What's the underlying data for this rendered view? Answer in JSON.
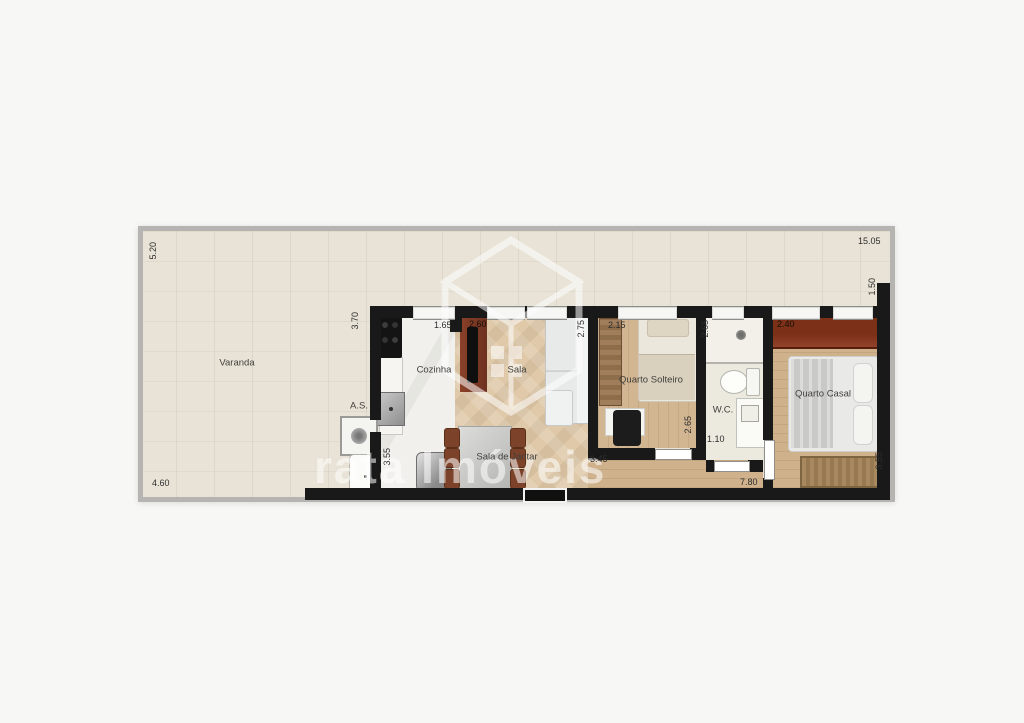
{
  "watermark": {
    "text": "rata Imóveis"
  },
  "rooms": {
    "varanda": "Varanda",
    "cozinha": "Cozinha",
    "area_servico": "A.S.",
    "sala": "Sala",
    "sala_jantar": "Sala de Jantar",
    "quarto_solteiro": "Quarto Solteiro",
    "wc": "W.C.",
    "quarto_casal": "Quarto Casal"
  },
  "dimensions": {
    "varanda_height": "5.20",
    "varanda_width": "4.60",
    "total_width": "15.05",
    "varanda_right_depth": "1.50",
    "left_section_height": "3.70",
    "cozinha_width": "1.65",
    "cozinha_height": "3.55",
    "sala_width": "2.60",
    "sala_height": "2.75",
    "quarto_solteiro_width": "2.15",
    "quarto_solteiro_height": "2.65",
    "solteiro_wc_span": "3.45",
    "wc_height": "2.65",
    "wc_width": "1.10",
    "quarto_casal_width": "2.40",
    "quarto_casal_height": "3.55",
    "hall_span": "7.80"
  },
  "colors": {
    "interior_wall": "#191919",
    "outer_wall": "#b5b4b0",
    "balcony_tile": "#e8e3d6",
    "wood_floor": "#cfb18c",
    "accent_wardrobe": "#7c3018"
  }
}
